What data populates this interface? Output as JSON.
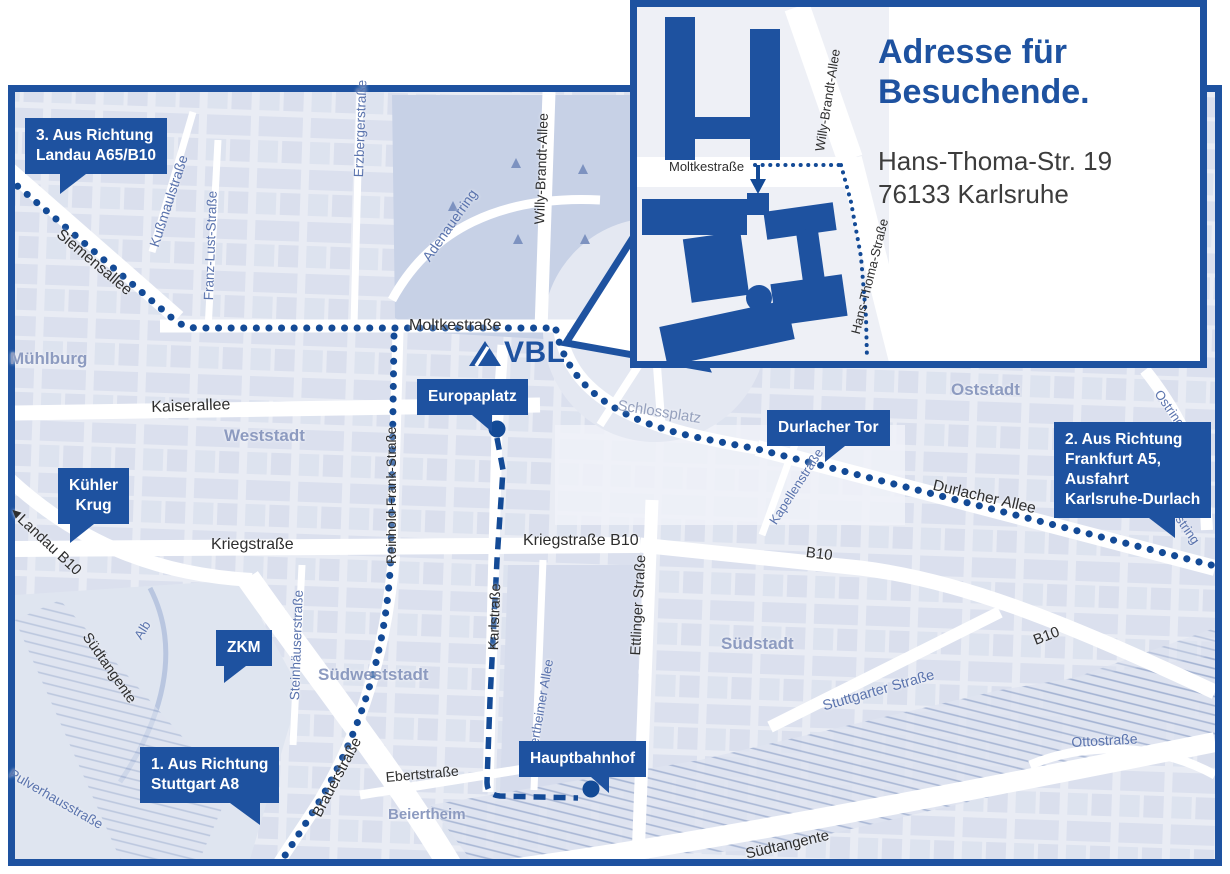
{
  "colors": {
    "brand_blue": "#1e52a0",
    "route_blue": "#134a96",
    "map_bg": "#e9ecf4",
    "park_fill": "#c7d1e6",
    "district_text": "#8d9bc0",
    "street_text_dark": "#2e2e2e",
    "street_text_blue": "#5a73ad"
  },
  "logo": {
    "text": "VBL"
  },
  "icons": {
    "direction_arrow": "◀"
  },
  "inset": {
    "title_line1": "Adresse für",
    "title_line2": "Besuchende.",
    "address_line1": "Hans-Thoma-Str. 19",
    "address_line2": "76133 Karlsruhe",
    "streets": {
      "moltkestrasse": "Moltkestraße",
      "willy_brandt_allee": "Willy-Brandt-Allee",
      "hans_thoma_strasse": "Hans-Thoma-Straße"
    }
  },
  "callouts": {
    "landau": {
      "line1": "3. Aus Richtung",
      "line2": "Landau A65/B10"
    },
    "frankfurt": {
      "line1": "2. Aus Richtung",
      "line2": "Frankfurt A5,",
      "line3": "Ausfahrt",
      "line4": "Karlsruhe-Durlach"
    },
    "stuttgart": {
      "line1": "1. Aus Richtung",
      "line2": "Stuttgart A8"
    },
    "kuehler_krug": {
      "line1": "Kühler",
      "line2": "Krug"
    },
    "zkm": {
      "label": "ZKM"
    },
    "europaplatz": {
      "label": "Europaplatz"
    },
    "durlacher_tor": {
      "label": "Durlacher Tor"
    },
    "hauptbahnhof": {
      "label": "Hauptbahnhof"
    }
  },
  "streets": {
    "siemensallee": "Siemensallee",
    "kussmaulstrasse": "Kußmaulstraße",
    "franz_lust_strasse": "Franz-Lust-Straße",
    "erzbergerstrasse": "Erzbergerstraße",
    "adenauerring": "Adenauerring",
    "willy_brandt_allee": "Willy-Brandt-Allee",
    "moltkestrasse": "Moltkestraße",
    "kaiserallee": "Kaiserallee",
    "landau_b10": "Landau B10",
    "kriegstrasse": "Kriegstraße",
    "kriegstrasse_b10": "Kriegstraße B10",
    "reinhold_frank_strasse": "Reinhold-Frank-Straße",
    "schlossplatz": "Schlossplatz",
    "durlacher_allee": "Durlacher Allee",
    "kapellenstrasse": "Kapellenstraße",
    "b10_mid": "B10",
    "b10_right": "B10",
    "ostring_top": "Ostring",
    "ostring_bottom": "Ostring",
    "karlstrasse": "Karlstraße",
    "ettlinger_strasse": "Ettlinger Straße",
    "steinhaeuserstrasse": "Steinhäuserstraße",
    "beiertheimer_allee": "Beiertheimer Allee",
    "stuttgarter_strasse": "Stuttgarter Straße",
    "brauerstrasse": "Brauerstraße",
    "ebertstrasse": "Ebertstraße",
    "alb": "Alb",
    "suedtangente_left": "Südtangente",
    "suedtangente_bottom": "Südtangente",
    "pulverhausstrasse": "Pulverhausstraße",
    "ottostrasse": "Ottostraße"
  },
  "districts": {
    "muehlburg": "Mühlburg",
    "weststadt": "Weststadt",
    "suedweststadt": "Südweststadt",
    "suedstadt": "Südstadt",
    "oststadt": "Oststadt",
    "beiertheim": "Beiertheim"
  }
}
